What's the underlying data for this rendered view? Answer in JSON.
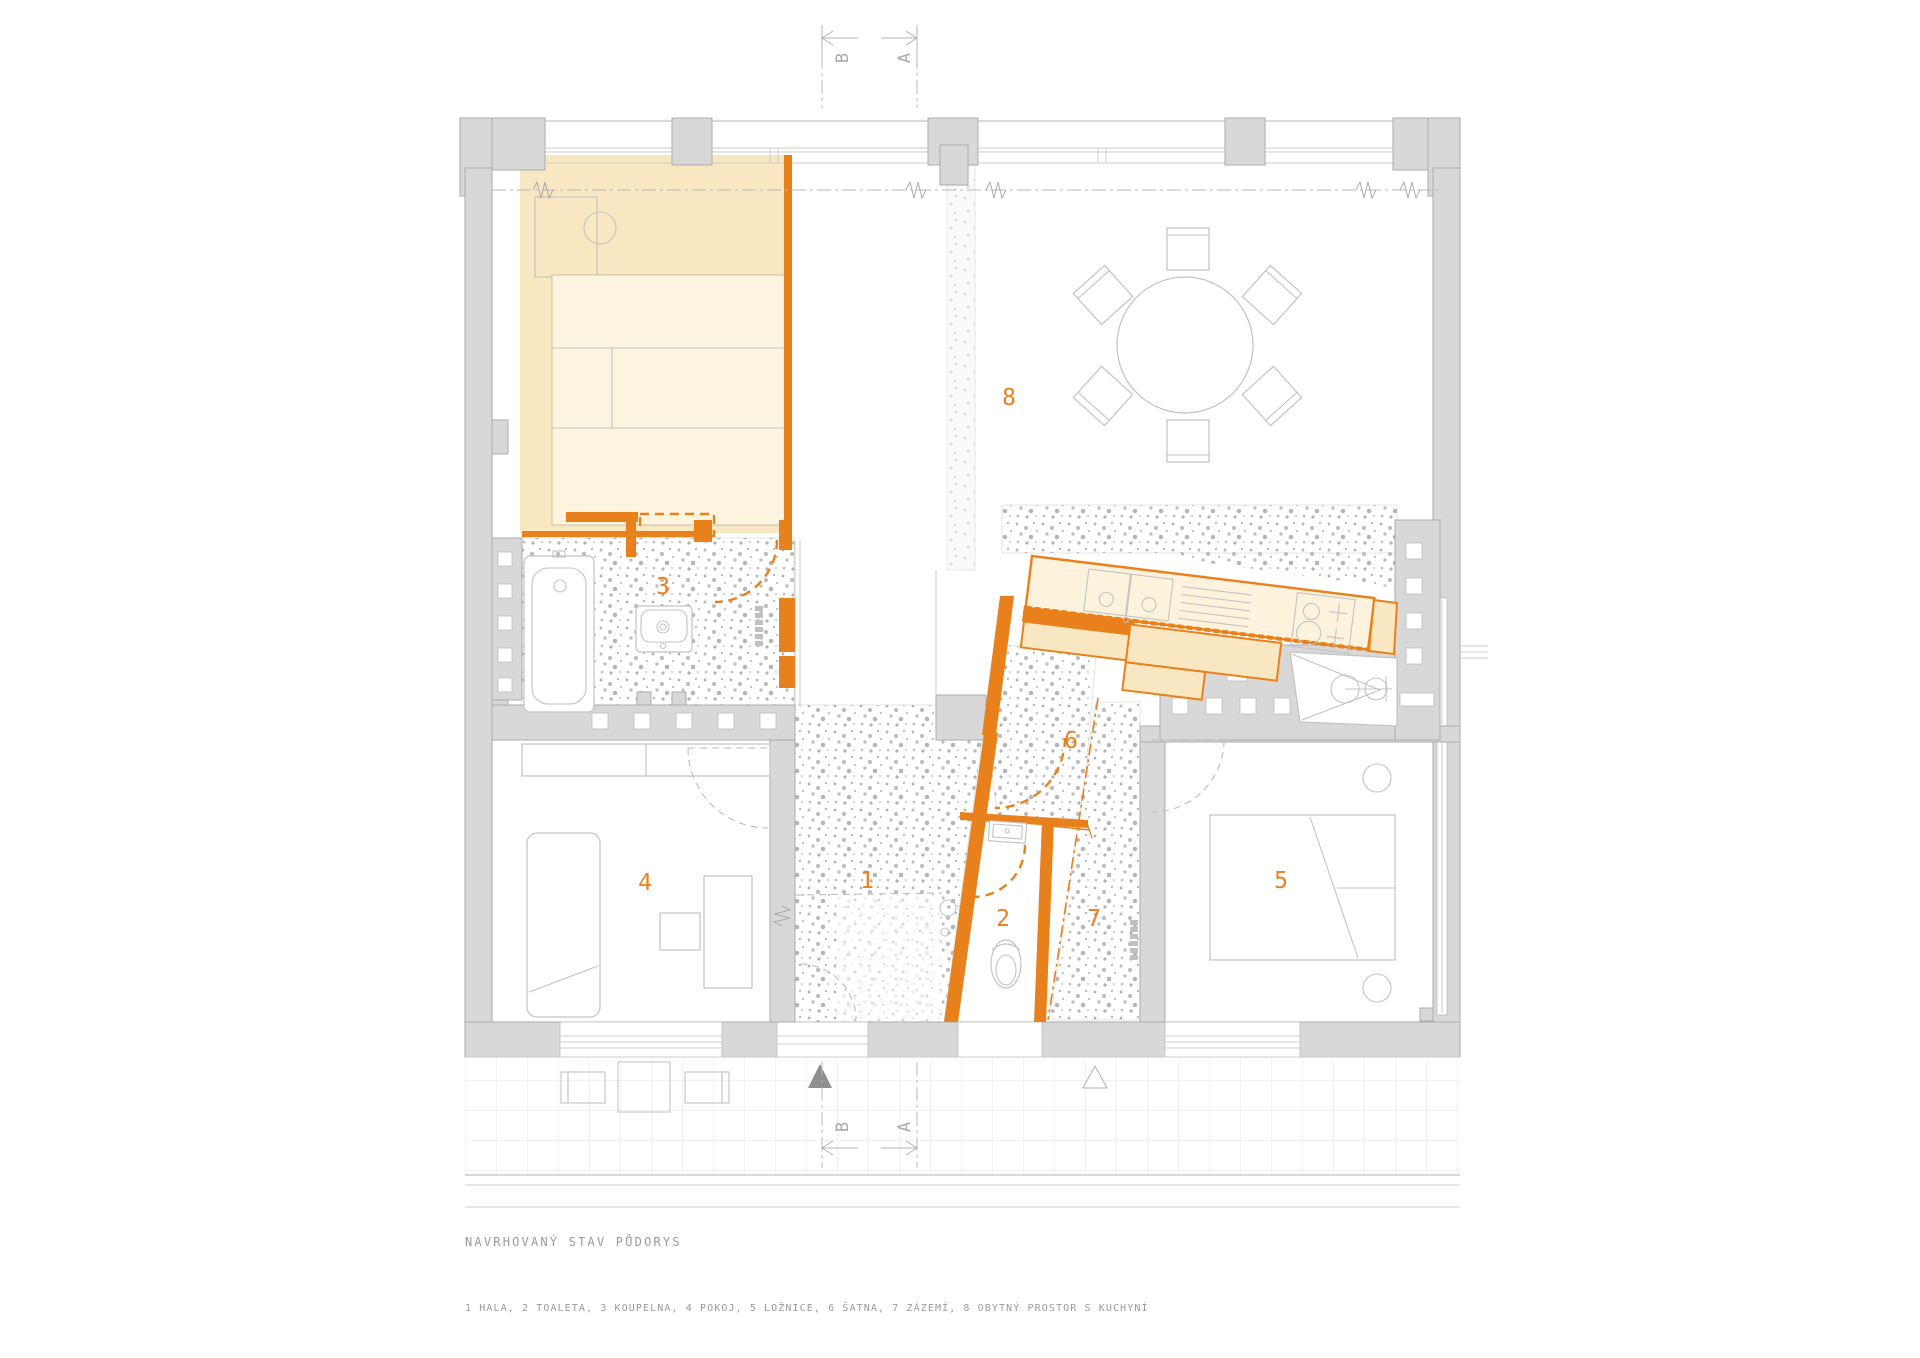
{
  "title": "NAVRHOVANÝ STAV PŮDORYS",
  "legend": "1 HALA, 2 TOALETA, 3 KOUPELNA, 4 POKOJ, 5 LOŽNICE, 6 ŠATNA, 7 ZÁZEMÍ, 8 OBYTNÝ PROSTOR S KUCHYNÍ",
  "rooms": [
    {
      "number": "1",
      "name": "HALA"
    },
    {
      "number": "2",
      "name": "TOALETA"
    },
    {
      "number": "3",
      "name": "KOUPELNA"
    },
    {
      "number": "4",
      "name": "POKOJ"
    },
    {
      "number": "5",
      "name": "LOŽNICE"
    },
    {
      "number": "6",
      "name": "ŠATNA"
    },
    {
      "number": "7",
      "name": "ZÁZEMÍ"
    },
    {
      "number": "8",
      "name": "OBYTNÝ PROSTOR S KUCHYNÍ"
    }
  ],
  "section_markers": {
    "top": [
      "B",
      "A"
    ],
    "bottom": [
      "B",
      "A"
    ]
  },
  "colors": {
    "accent_orange": "#E8811B",
    "new_floor_yellow": "#F8E7C0",
    "furniture_cream": "#FDF4DF",
    "wall_gray": "#D8D8D8",
    "annotation_gray": "#9A9A9A"
  }
}
